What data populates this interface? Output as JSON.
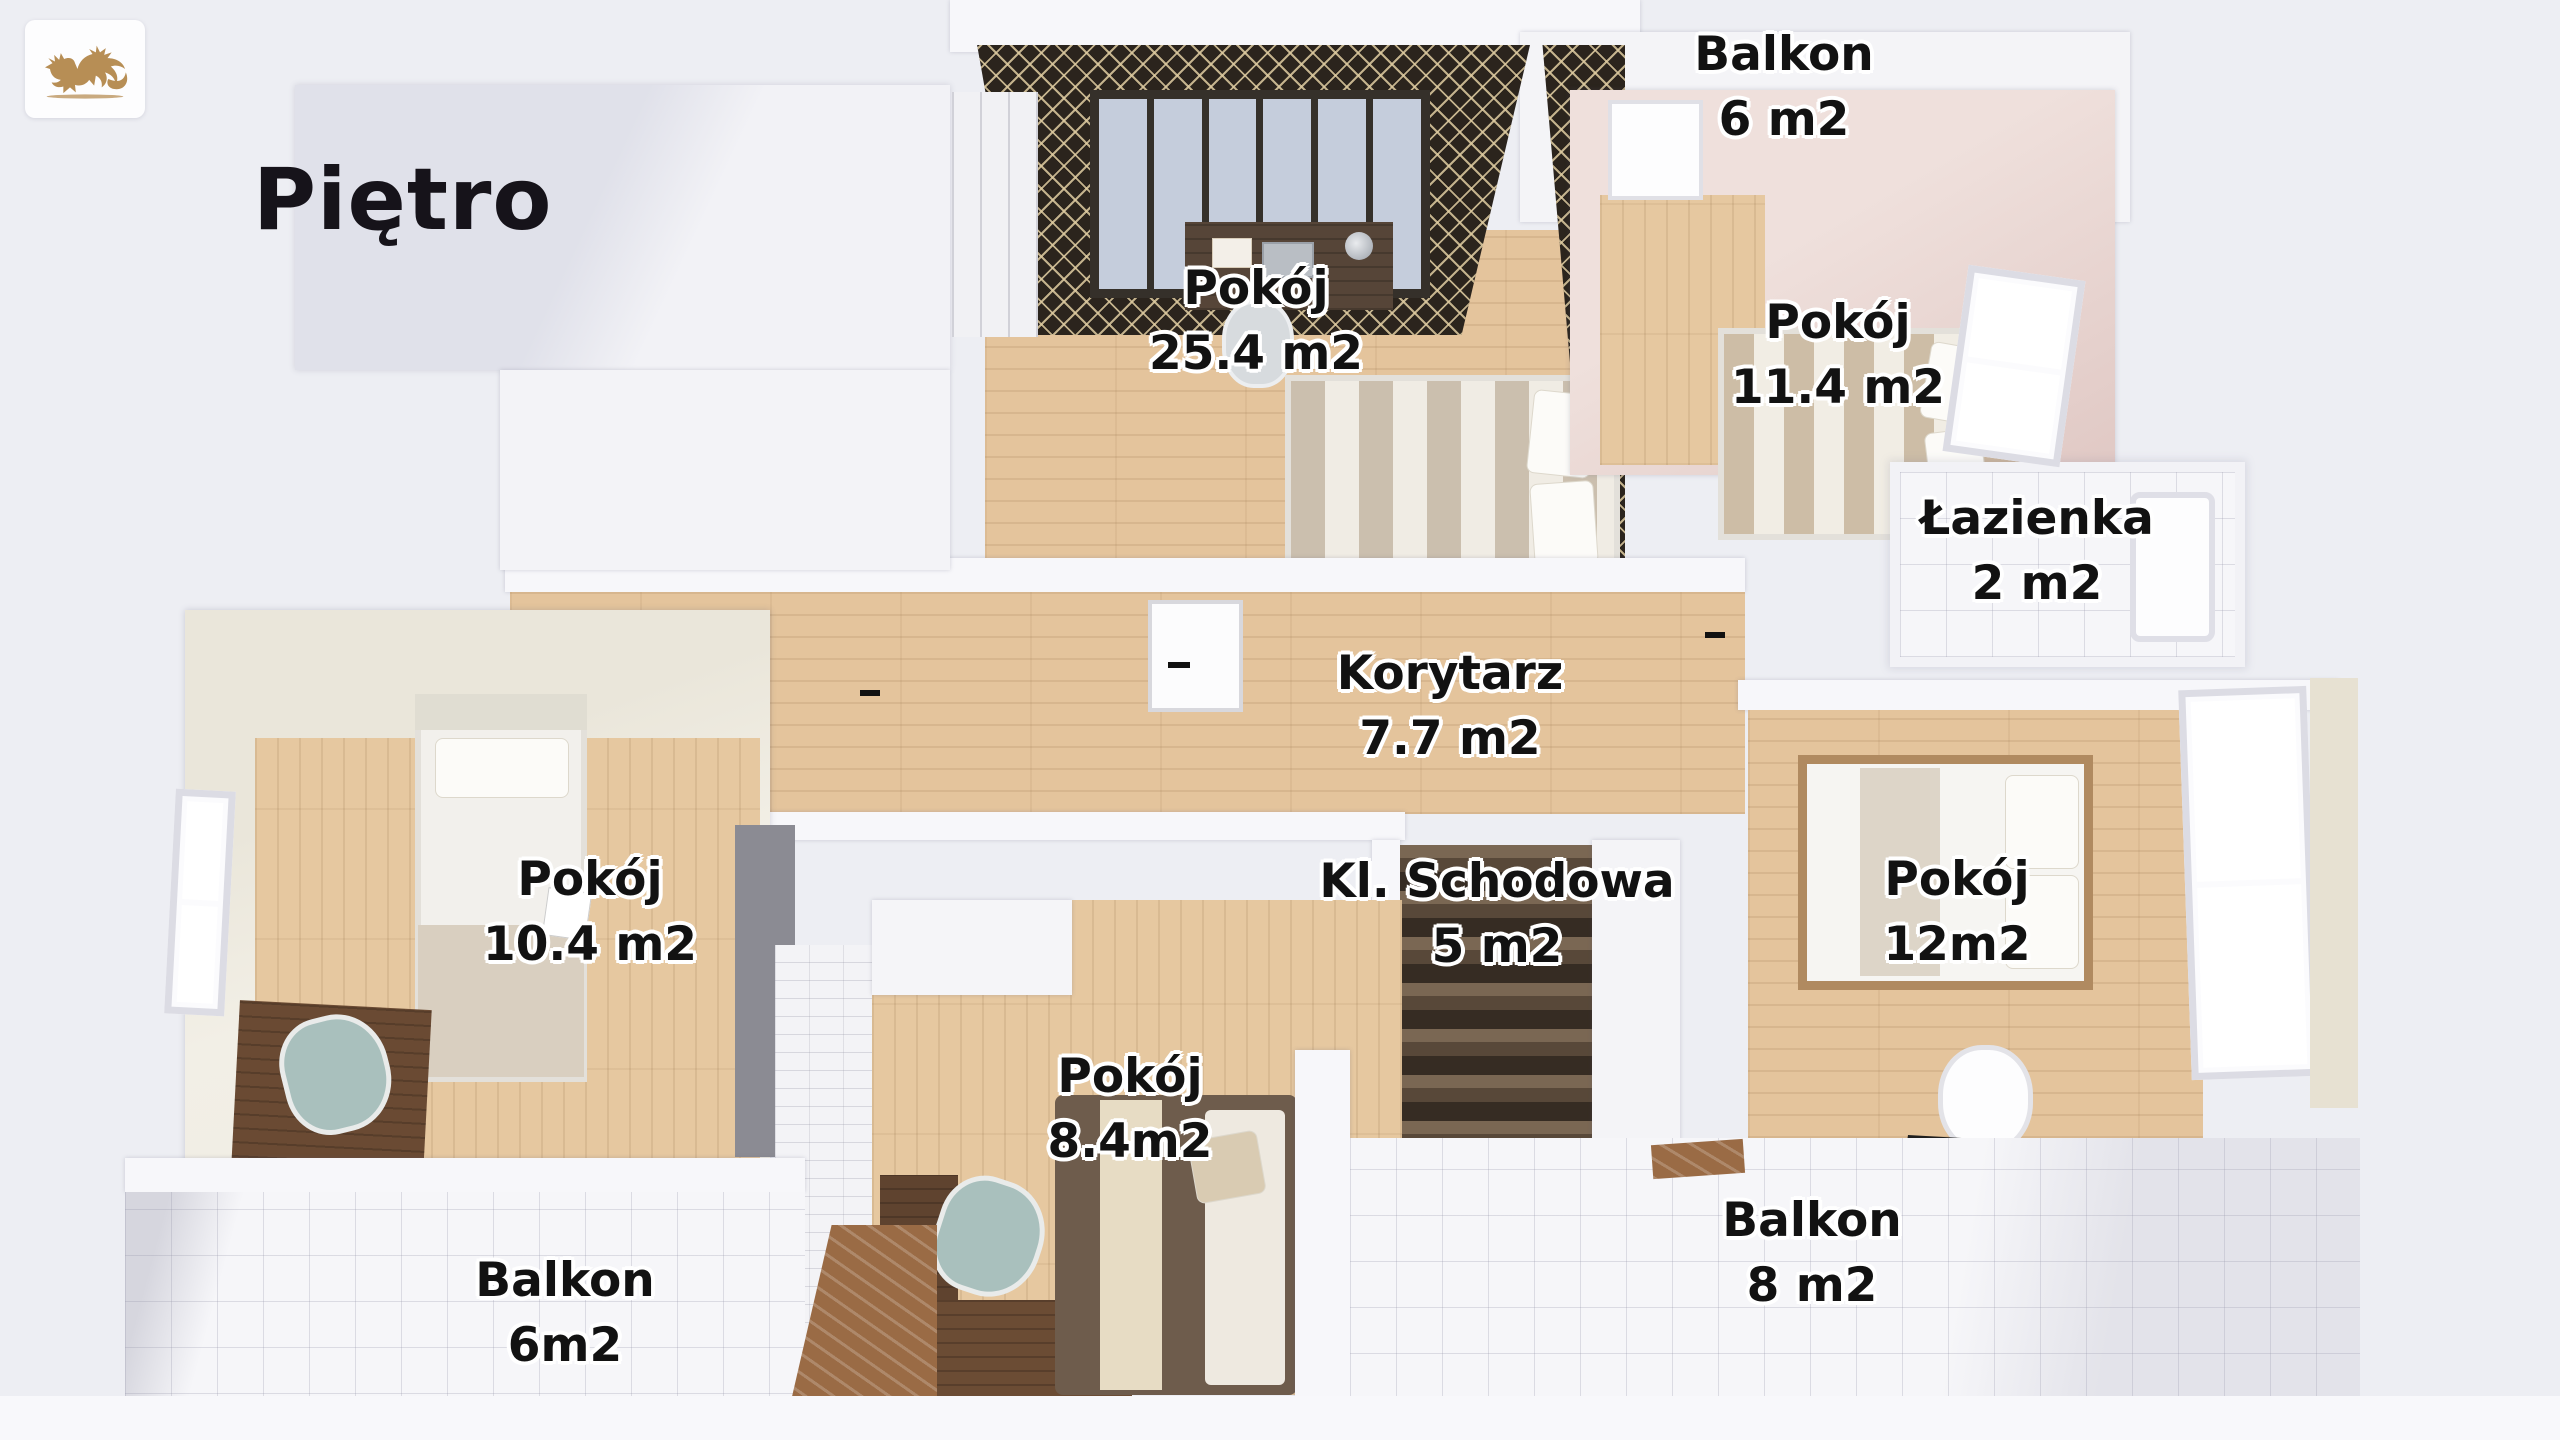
{
  "title": "Piętro",
  "logo": {
    "name": "gold-dragon-logo",
    "color": "#b78e55"
  },
  "rooms": [
    {
      "id": "pokoj-25",
      "name": "Pokój",
      "area": "25.4 m2"
    },
    {
      "id": "pokoj-11-4",
      "name": "Pokój",
      "area": "11.4 m2"
    },
    {
      "id": "lazienka",
      "name": "Łazienka",
      "area": "2 m2"
    },
    {
      "id": "korytarz",
      "name": "Korytarz",
      "area": "7.7 m2"
    },
    {
      "id": "kl-schodowa",
      "name": "Kl. Schodowa",
      "area": "5 m2"
    },
    {
      "id": "pokoj-12",
      "name": "Pokój",
      "area": "12m2"
    },
    {
      "id": "pokoj-10-4",
      "name": "Pokój",
      "area": "10.4 m2"
    },
    {
      "id": "pokoj-8-4",
      "name": "Pokój",
      "area": "8.4m2"
    },
    {
      "id": "balkon-top",
      "name": "Balkon",
      "area": "6 m2"
    },
    {
      "id": "balkon-left",
      "name": "Balkon",
      "area": "6m2"
    },
    {
      "id": "balkon-right",
      "name": "Balkon",
      "area": "8 m2"
    }
  ],
  "colors": {
    "background": "#edeef3",
    "wood_floor": "#e4c49c",
    "dark_wallpaper": "#2b241d",
    "wallpaper_pattern": "#d9c49a",
    "pink_wall": "#e5d0cc",
    "tile": "#f6f6f9",
    "logo_gold": "#b78e55",
    "label_text": "#121212",
    "label_halo": "#ffffff"
  }
}
